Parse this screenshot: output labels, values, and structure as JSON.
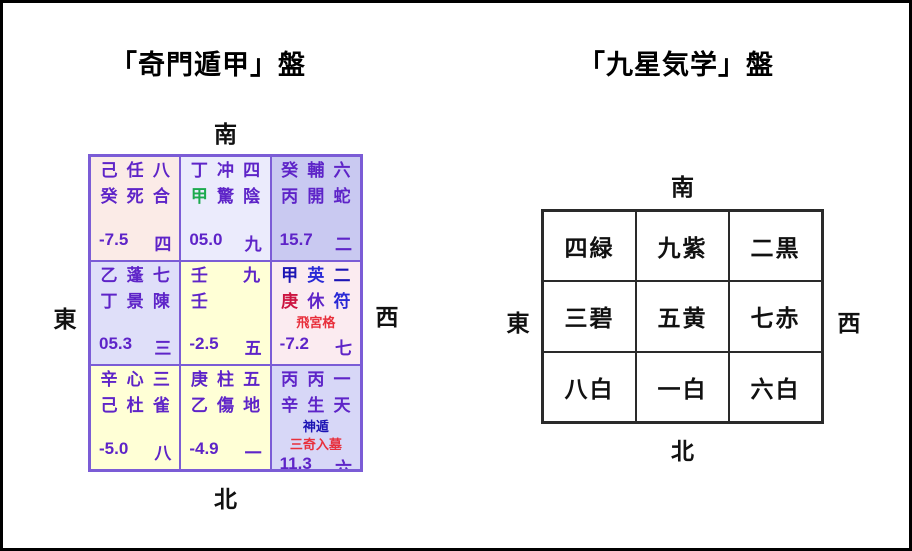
{
  "page": {
    "left_title": "「奇門遁甲」盤",
    "right_title": "「九星気学」盤"
  },
  "qimen": {
    "directions": {
      "south": "南",
      "east": "東",
      "west": "西",
      "north": "北"
    },
    "palette": {
      "text_purple": "#5e24c8",
      "border_purple": "#7b5cd6",
      "green_stem": "#1caa4e",
      "navy_text": "#1c14b4",
      "blue_text": "#2929d6",
      "crimson_stem": "#cc1440",
      "red_note": "#e8303c",
      "cell_pink": "#fbebe7",
      "cell_pale_lavender": "#ebebfc",
      "cell_medium_lavender": "#c9c9f1",
      "cell_lavender": "#dfdff9",
      "cell_yellow": "#ffffd6",
      "cell_pink2": "#fbebf0",
      "cell_lavender2": "#d7d7f7"
    },
    "cells": [
      {
        "r1": [
          "己",
          "任",
          "八"
        ],
        "r2": [
          "癸",
          "死",
          "合"
        ],
        "score": "-7.5",
        "num": "四"
      },
      {
        "r1": [
          "丁",
          "冲",
          "四"
        ],
        "r2": [
          "甲",
          "驚",
          "陰"
        ],
        "score": "05.0",
        "num": "九"
      },
      {
        "r1": [
          "癸",
          "輔",
          "六"
        ],
        "r2": [
          "丙",
          "開",
          "蛇"
        ],
        "score": "15.7",
        "num": "二"
      },
      {
        "r1": [
          "乙",
          "蓬",
          "七"
        ],
        "r2": [
          "丁",
          "景",
          "陳"
        ],
        "score": "05.3",
        "num": "三"
      },
      {
        "r1": [
          "壬",
          "",
          "九"
        ],
        "r2": [
          "壬",
          "",
          ""
        ],
        "score": "-2.5",
        "num": "五"
      },
      {
        "r1": [
          "甲",
          "英",
          "二"
        ],
        "r2": [
          "庚",
          "休",
          "符"
        ],
        "note1": "飛宮格",
        "score": "-7.2",
        "num": "七"
      },
      {
        "r1": [
          "辛",
          "心",
          "三"
        ],
        "r2": [
          "己",
          "杜",
          "雀"
        ],
        "score": "-5.0",
        "num": "八"
      },
      {
        "r1": [
          "庚",
          "柱",
          "五"
        ],
        "r2": [
          "乙",
          "傷",
          "地"
        ],
        "score": "-4.9",
        "num": "一"
      },
      {
        "r1": [
          "丙",
          "丙",
          "一"
        ],
        "r2": [
          "辛",
          "生",
          "天"
        ],
        "note1": "神遁",
        "note2": "三奇入墓",
        "score": "11.3",
        "num": "六"
      }
    ]
  },
  "kyusei": {
    "directions": {
      "south": "南",
      "east": "東",
      "west": "西",
      "north": "北"
    },
    "cells": [
      "四緑",
      "九紫",
      "二黒",
      "三碧",
      "五黄",
      "七赤",
      "八白",
      "一白",
      "六白"
    ]
  }
}
